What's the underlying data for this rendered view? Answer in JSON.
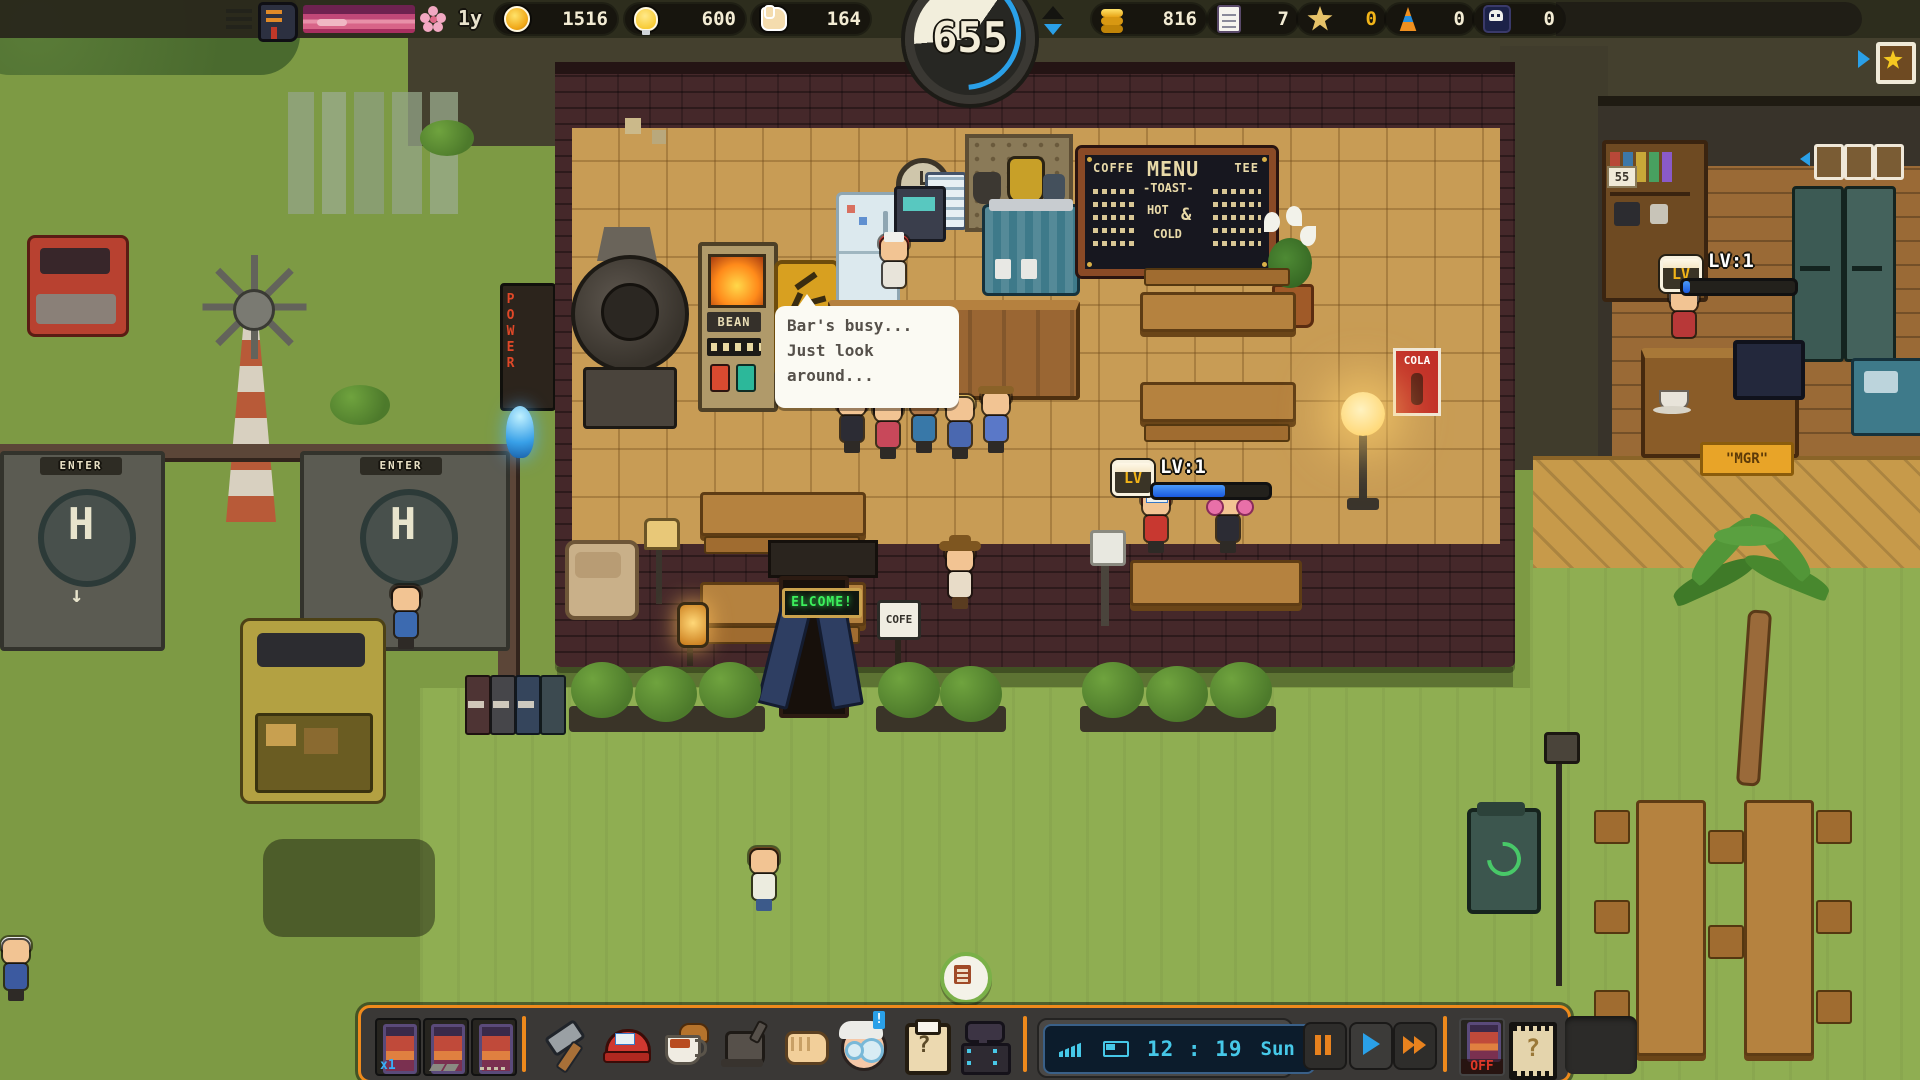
{
  "hud": {
    "season_label": "1y",
    "coins": "1516",
    "ideas": "600",
    "likes": "164",
    "timer": "655",
    "money": "816",
    "orders": "7",
    "stars": "0",
    "cones": "0",
    "skulls": "0"
  },
  "dialogue": {
    "line1": "Bar's busy...",
    "line2": "Just look",
    "line3": "around..."
  },
  "menu_board": {
    "col_left": "COFFE",
    "title": "MENU",
    "col_right": "TEE",
    "toast": "-TOAST-",
    "hot": "HOT",
    "amp": "&",
    "cold": "COLD"
  },
  "signs": {
    "welcome": "ELCOME!",
    "cafe_sign": "COFE",
    "cola": "COLA",
    "bean": "BEAN",
    "mgr": "\"MGR\"",
    "power": "POWER",
    "caution": "CAU",
    "enter_left": "ENTER",
    "enter_right": "ENTER",
    "helipad_h_left": "H",
    "helipad_h_right": "H",
    "shelf_tag": "55"
  },
  "levels": {
    "badge": "LV",
    "customer_label": "LV:1",
    "customer_progress": 62,
    "manager_label": "LV:1",
    "manager_progress": 6
  },
  "npcs": {
    "cap_patch": "MG"
  },
  "toolbar": {
    "slot_multiplier": "x1",
    "clipboard_glyph": "?",
    "ticket_glyph": "?",
    "notification": "!",
    "time": "12 : 19",
    "day": "Sun",
    "off_label": "OFF"
  }
}
